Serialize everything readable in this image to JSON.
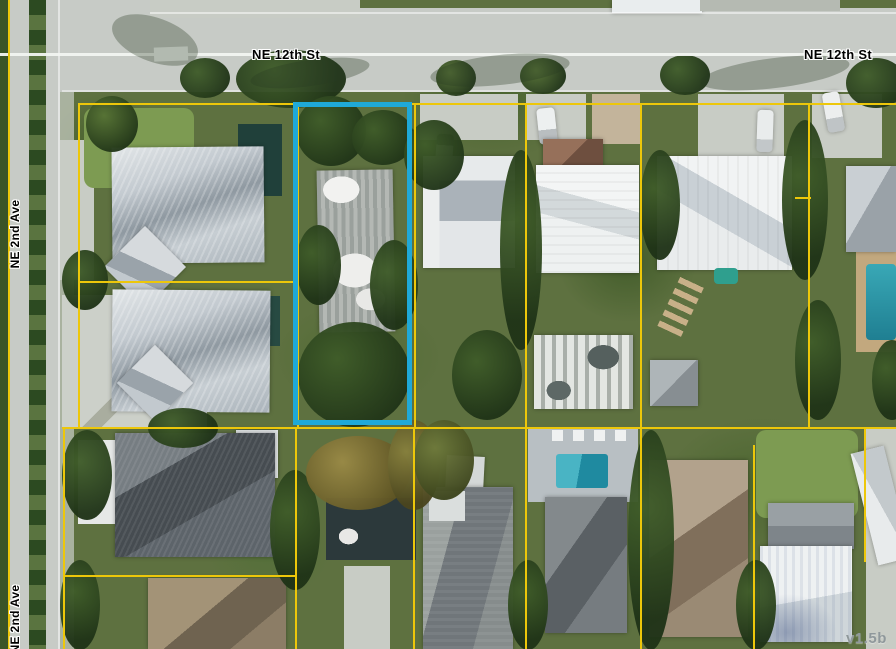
{
  "map": {
    "streets": {
      "ne12th_left": "NE 12th St",
      "ne12th_right": "NE 12th St",
      "ne2nd_upper": "NE 2nd Ave",
      "ne2nd_lower": "NE 2nd Ave"
    },
    "version": "v1.5b",
    "colors": {
      "highlight": "#1FA9D8",
      "parcel-line": "#EDC70A",
      "street-label": "#000000",
      "label-halo": "#FFFFFF",
      "version-color": "#8F989B",
      "road": "#C7CBC6",
      "centerline": "#F2F4F1"
    }
  }
}
